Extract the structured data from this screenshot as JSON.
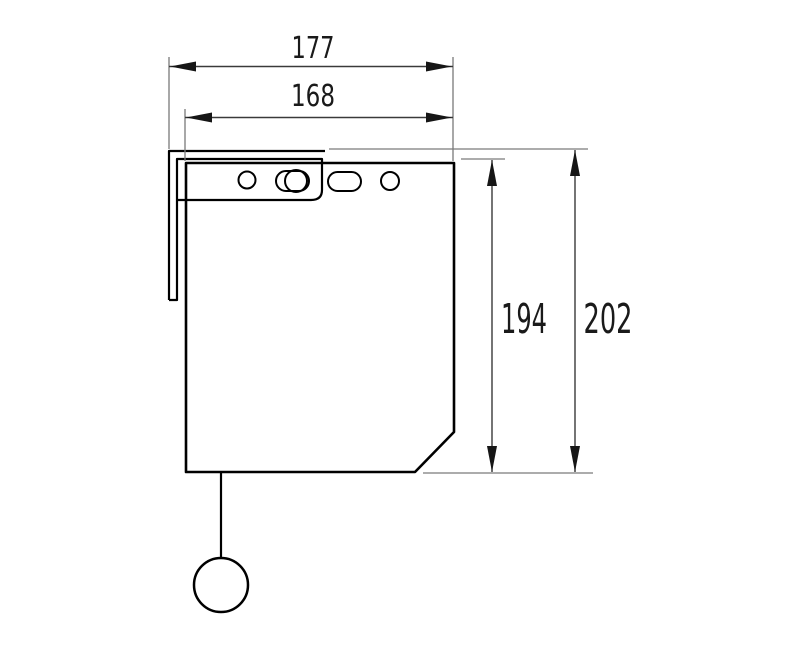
{
  "dimensions": {
    "width_outer": "177",
    "width_inner": "168",
    "height_body": "194",
    "height_overall": "202"
  },
  "colors": {
    "background": "#ffffff",
    "outline": "#000000",
    "dimension_line": "#3a3a3a",
    "extension_line": "#7a7a7a",
    "arrow": "#161616",
    "text": "#1a1a1a"
  }
}
